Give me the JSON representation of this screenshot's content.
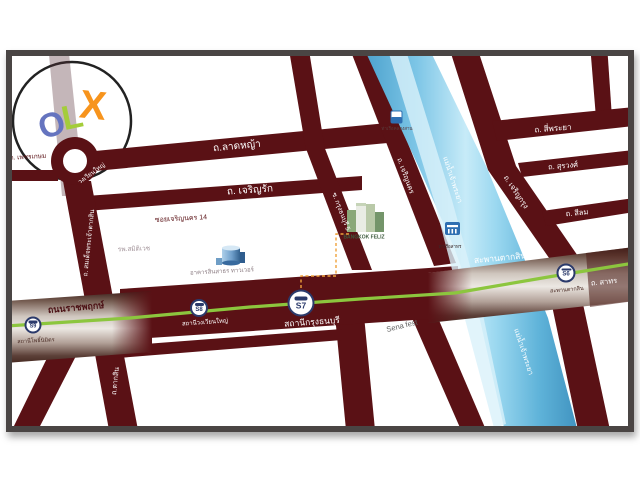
{
  "logo": {
    "o": "O",
    "l": "L",
    "x": "X"
  },
  "colors": {
    "road": "#5a1115",
    "river": "#7cc5e6",
    "river_edge": "#4aa0cc",
    "green_line": "#8cc63e",
    "silver": "#d8d2cb",
    "dark_band": "#40241e",
    "navy": "#2b3a6b",
    "frame": "#4a4544",
    "orange": "#f7941d",
    "letter_o": "#6574bf",
    "letter_l": "#a4cd3a",
    "accent_dash": "#f0a23c"
  },
  "map": {
    "roads": {
      "phetkasem": "ถ. เพชรเกษม",
      "wongwian_yai": "วงเวียนใหญ่",
      "lat_ya": "ถ.ลาดหญ้า",
      "charoen_rak": "ถ. เจริญรัก",
      "soi_charoen_nakhon_14": "ซอยเจริญนคร 14",
      "somdet_taksin": "ถ. สมเด็จพระเจ้าตากสิน",
      "taksin": "ถ.ตากสิน",
      "ratchaphruek": "ถนนราชพฤกษ์",
      "soi_krung_thonburi": "ซ. กรุงธนบุรี 5",
      "charoen_nakhon": "ถ. เจริญนคร",
      "charoen_krung": "ถ. เจริญกรุง",
      "si_phraya": "ถ. สี่พระยา",
      "surawong": "ถ. สุรวงศ์",
      "silom": "ถ. สีลม",
      "sathorn": "ถ. สาทร",
      "taksin_bridge": "สะพานตากสิน"
    },
    "river": {
      "name": "แม่น้ำเจ้าพระยา"
    },
    "stations": [
      {
        "code": "S9",
        "name": "สถานีโพธิ์นิมิตร"
      },
      {
        "code": "S8",
        "name": "สถานีวงเวียนใหญ่"
      },
      {
        "code": "S7",
        "name": "สถานีกรุงธนบุรี"
      },
      {
        "code": "S6",
        "name": "สะพานตากสิน"
      }
    ],
    "pois": {
      "hospital": "รพ.สมิติเวช",
      "sinsathorn_tower": "อาคารสินสาธร ทาวเวอร์",
      "bangkok_feliz": "BANGKOK FELIZ",
      "sena_fest": "Sena fest",
      "pier_khlong_san": "ท่าเรือคลองสาน",
      "pier_sathorn": "ท่าเรือสาทร"
    }
  }
}
